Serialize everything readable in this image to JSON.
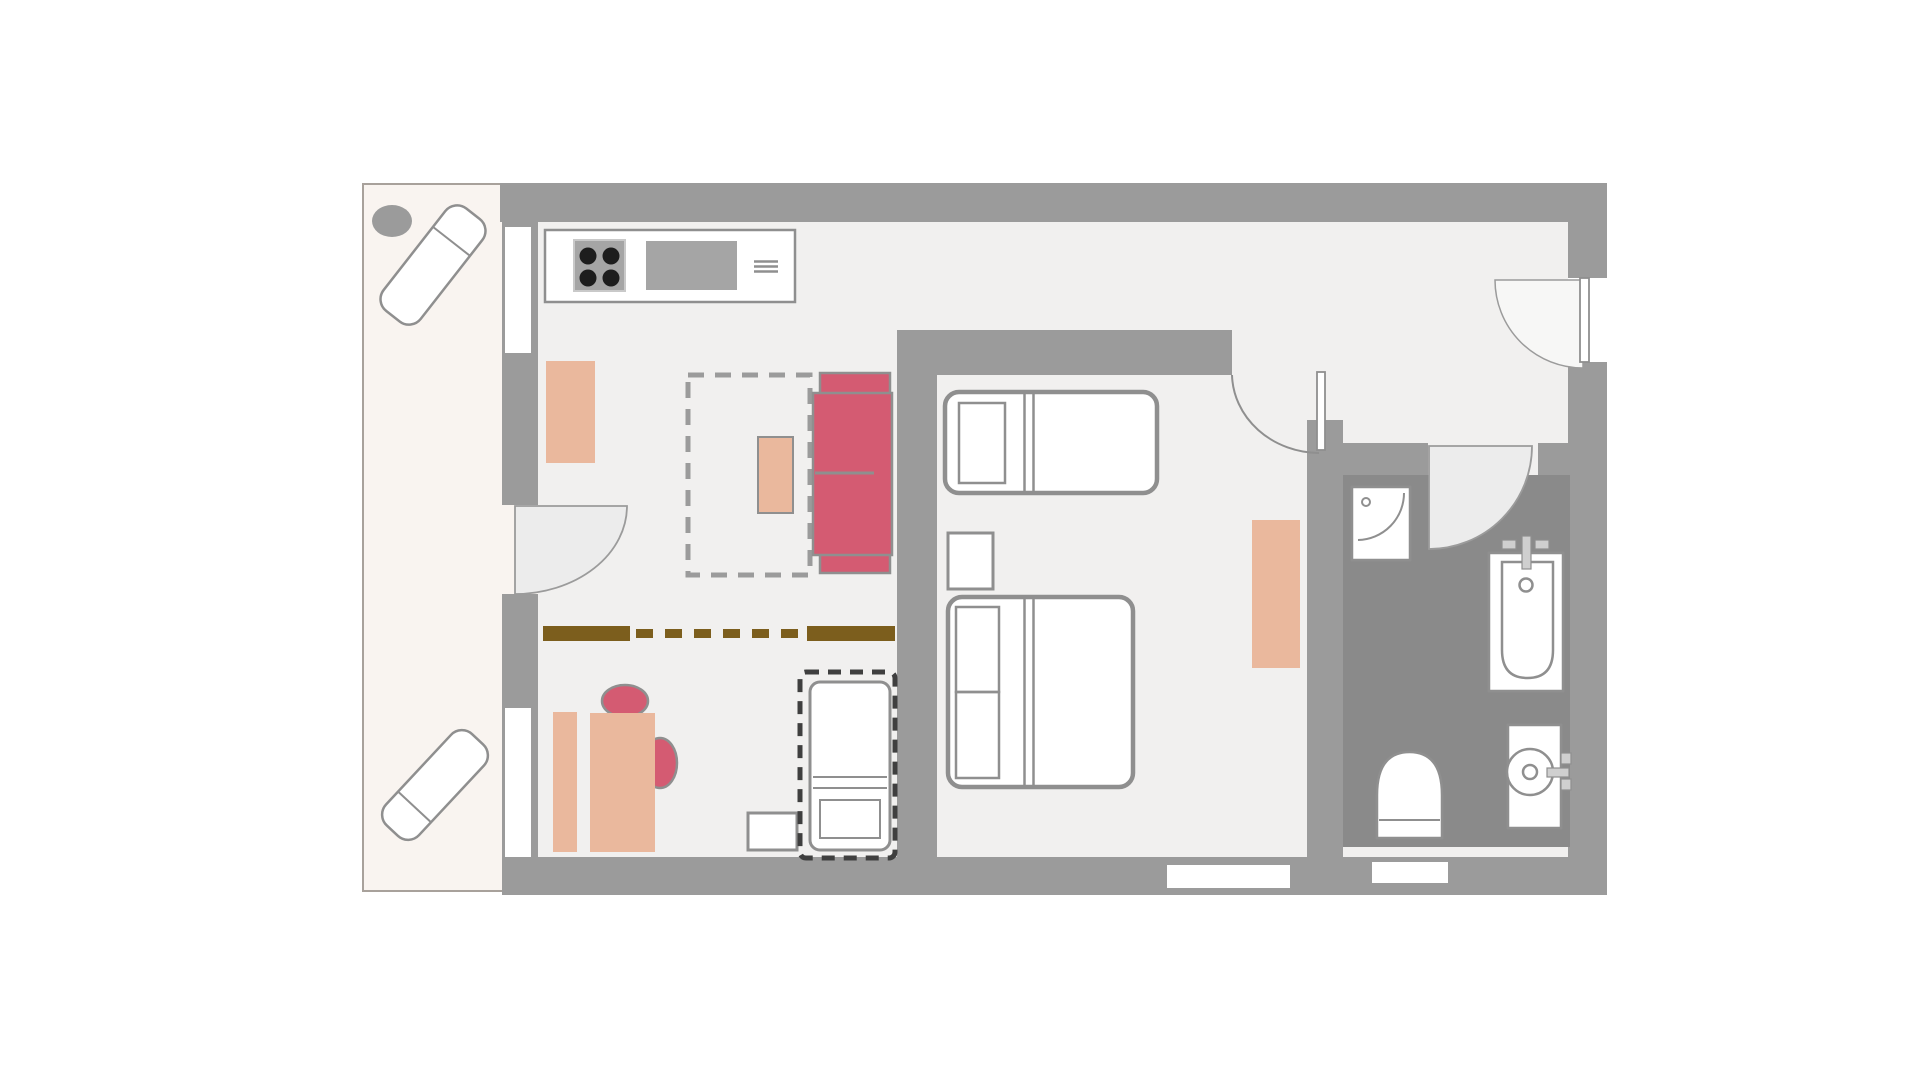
{
  "title": "apartment-floor-plan",
  "colors": {
    "wall": "#9b9b9b",
    "floor": "#f1f0ef",
    "balcony_floor": "#f9f4f0",
    "balcony_border": "#a8a19b",
    "bathroom_floor": "#8a8a8a",
    "outline": "#8f8f8f",
    "white": "#ffffff",
    "accent_red": "#d45b72",
    "accent_peach": "#eab89d",
    "divider_brown": "#7c5e1d",
    "dash_dark": "#3f3f3f",
    "appliance": "#a5a5a5",
    "appliance_border": "#c9c9c9",
    "burner": "#1d1d1d",
    "door_swing": "#ececec",
    "door_swing_light": "#f7f7f6",
    "fitting": "#cfcfcf"
  },
  "rooms": {
    "balcony": "balcony",
    "living_kitchen": "living-kitchen-area",
    "dining": "dining-area",
    "bedroom": "bedroom",
    "hallway": "hallway",
    "bathroom": "bathroom"
  }
}
